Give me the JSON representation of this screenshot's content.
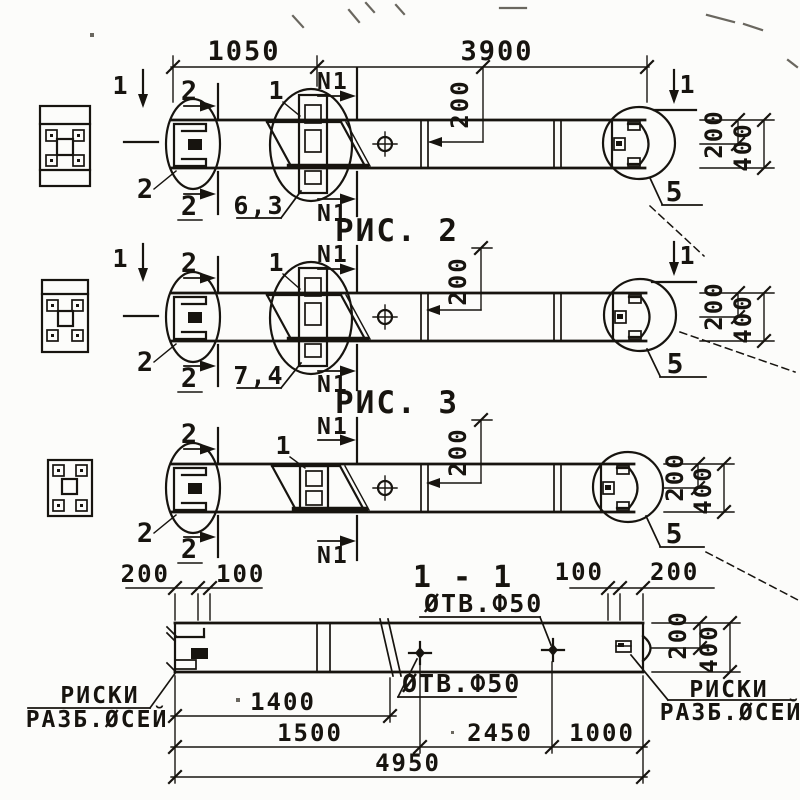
{
  "colors": {
    "ink": "#17140f",
    "paper": "#fcfcfa",
    "artifact": "#6a675f"
  },
  "labels": [
    {
      "n": "dim-1050",
      "t": "1050",
      "x": 244,
      "y": 60,
      "r": 0,
      "s": 27,
      "a": "middle"
    },
    {
      "n": "dim-3900",
      "t": "3900",
      "x": 497,
      "y": 60,
      "r": 0,
      "s": 27,
      "a": "middle"
    },
    {
      "n": "b1-dim-200-mid",
      "t": "200",
      "x": 468,
      "y": 104,
      "r": -90,
      "s": 24,
      "a": "middle"
    },
    {
      "n": "b1-section2-top",
      "t": "2",
      "x": 190,
      "y": 100,
      "r": 0,
      "s": 27,
      "a": "middle"
    },
    {
      "n": "b1-section2-bottom",
      "t": "2",
      "x": 190,
      "y": 215,
      "r": 0,
      "s": 27,
      "a": "middle"
    },
    {
      "n": "b1-leader-2",
      "t": "2",
      "x": 146,
      "y": 198,
      "r": 0,
      "s": 27,
      "a": "middle"
    },
    {
      "n": "b1-leader-1",
      "t": "1",
      "x": 277,
      "y": 99,
      "r": 0,
      "s": 25,
      "a": "middle"
    },
    {
      "n": "b1-n1-top",
      "t": "N1",
      "x": 317,
      "y": 89,
      "r": 0,
      "s": 23,
      "a": "start"
    },
    {
      "n": "b1-n1-bottom",
      "t": "N1",
      "x": 317,
      "y": 221,
      "r": 0,
      "s": 23,
      "a": "start"
    },
    {
      "n": "b1-weld-6-3",
      "t": "6,3",
      "x": 259,
      "y": 214,
      "r": 0,
      "s": 25,
      "a": "middle"
    },
    {
      "n": "b1-section1-left",
      "t": "1",
      "x": 121,
      "y": 94,
      "r": 0,
      "s": 25,
      "a": "middle"
    },
    {
      "n": "b1-section1-right",
      "t": "1",
      "x": 688,
      "y": 93,
      "r": 0,
      "s": 25,
      "a": "middle"
    },
    {
      "n": "b1-detail-5",
      "t": "5",
      "x": 675,
      "y": 201,
      "r": 0,
      "s": 28,
      "a": "middle"
    },
    {
      "n": "b1-dim-200-right",
      "t": "200",
      "x": 722,
      "y": 134,
      "r": -90,
      "s": 24,
      "a": "middle"
    },
    {
      "n": "b1-dim-400-right",
      "t": "400",
      "x": 751,
      "y": 147,
      "r": -90,
      "s": 24,
      "a": "middle"
    },
    {
      "n": "caption-fig-2",
      "t": "РИС. 2",
      "x": 397,
      "y": 241,
      "r": 0,
      "s": 31,
      "a": "middle"
    },
    {
      "n": "b2-dim-200-mid",
      "t": "200",
      "x": 466,
      "y": 281,
      "r": -90,
      "s": 24,
      "a": "middle"
    },
    {
      "n": "b2-section2-top",
      "t": "2",
      "x": 190,
      "y": 272,
      "r": 0,
      "s": 27,
      "a": "middle"
    },
    {
      "n": "b2-section2-bottom",
      "t": "2",
      "x": 190,
      "y": 387,
      "r": 0,
      "s": 27,
      "a": "middle"
    },
    {
      "n": "b2-leader-2",
      "t": "2",
      "x": 146,
      "y": 371,
      "r": 0,
      "s": 27,
      "a": "middle"
    },
    {
      "n": "b2-leader-1",
      "t": "1",
      "x": 277,
      "y": 271,
      "r": 0,
      "s": 25,
      "a": "middle"
    },
    {
      "n": "b2-n1-top",
      "t": "N1",
      "x": 317,
      "y": 262,
      "r": 0,
      "s": 23,
      "a": "start"
    },
    {
      "n": "b2-n1-bottom",
      "t": "N1",
      "x": 317,
      "y": 392,
      "r": 0,
      "s": 23,
      "a": "start"
    },
    {
      "n": "b2-weld-7-4",
      "t": "7,4",
      "x": 259,
      "y": 384,
      "r": 0,
      "s": 25,
      "a": "middle"
    },
    {
      "n": "b2-section1-left",
      "t": "1",
      "x": 121,
      "y": 267,
      "r": 0,
      "s": 25,
      "a": "middle"
    },
    {
      "n": "b2-section1-right",
      "t": "1",
      "x": 688,
      "y": 264,
      "r": 0,
      "s": 25,
      "a": "middle"
    },
    {
      "n": "b2-detail-5",
      "t": "5",
      "x": 676,
      "y": 373,
      "r": 0,
      "s": 28,
      "a": "middle"
    },
    {
      "n": "b2-dim-200-right",
      "t": "200",
      "x": 722,
      "y": 306,
      "r": -90,
      "s": 24,
      "a": "middle"
    },
    {
      "n": "b2-dim-400-right",
      "t": "400",
      "x": 751,
      "y": 319,
      "r": -90,
      "s": 24,
      "a": "middle"
    },
    {
      "n": "caption-fig-3",
      "t": "РИС. 3",
      "x": 397,
      "y": 413,
      "r": 0,
      "s": 31,
      "a": "middle"
    },
    {
      "n": "b3-dim-200-mid",
      "t": "200",
      "x": 466,
      "y": 452,
      "r": -90,
      "s": 24,
      "a": "middle"
    },
    {
      "n": "b3-section2-top",
      "t": "2",
      "x": 190,
      "y": 443,
      "r": 0,
      "s": 27,
      "a": "middle"
    },
    {
      "n": "b3-section2-bottom",
      "t": "2",
      "x": 190,
      "y": 558,
      "r": 0,
      "s": 27,
      "a": "middle"
    },
    {
      "n": "b3-leader-2",
      "t": "2",
      "x": 146,
      "y": 542,
      "r": 0,
      "s": 27,
      "a": "middle"
    },
    {
      "n": "b3-leader-1",
      "t": "1",
      "x": 284,
      "y": 454,
      "r": 0,
      "s": 25,
      "a": "middle"
    },
    {
      "n": "b3-n1-top",
      "t": "N1",
      "x": 317,
      "y": 434,
      "r": 0,
      "s": 23,
      "a": "start"
    },
    {
      "n": "b3-n1-bottom",
      "t": "N1",
      "x": 317,
      "y": 563,
      "r": 0,
      "s": 23,
      "a": "start"
    },
    {
      "n": "b3-detail-5",
      "t": "5",
      "x": 675,
      "y": 543,
      "r": 0,
      "s": 28,
      "a": "middle"
    },
    {
      "n": "b3-dim-200-right",
      "t": "200",
      "x": 683,
      "y": 477,
      "r": -90,
      "s": 24,
      "a": "middle"
    },
    {
      "n": "b3-dim-400-right",
      "t": "400",
      "x": 711,
      "y": 490,
      "r": -90,
      "s": 24,
      "a": "middle"
    },
    {
      "n": "caption-section-1-1",
      "t": "1 - 1",
      "x": 463,
      "y": 587,
      "r": 0,
      "s": 30,
      "a": "middle"
    },
    {
      "n": "note-otv-f50-top",
      "t": "ØТВ.Ф50",
      "x": 424,
      "y": 612,
      "r": 0,
      "s": 25,
      "a": "start"
    },
    {
      "n": "note-otv-f50-bottom",
      "t": "ØТВ.Ф50",
      "x": 402,
      "y": 692,
      "r": 0,
      "s": 25,
      "a": "start"
    },
    {
      "n": "s-dim-200-left",
      "t": "200",
      "x": 170,
      "y": 582,
      "r": 0,
      "s": 24,
      "a": "end"
    },
    {
      "n": "s-dim-100-left",
      "t": "100",
      "x": 216,
      "y": 582,
      "r": 0,
      "s": 24,
      "a": "start"
    },
    {
      "n": "s-dim-100-right",
      "t": "100",
      "x": 604,
      "y": 580,
      "r": 0,
      "s": 24,
      "a": "end"
    },
    {
      "n": "s-dim-200-right",
      "t": "200",
      "x": 650,
      "y": 580,
      "r": 0,
      "s": 24,
      "a": "start"
    },
    {
      "n": "s-dim-200-rdim",
      "t": "200",
      "x": 686,
      "y": 635,
      "r": -90,
      "s": 24,
      "a": "middle"
    },
    {
      "n": "s-dim-400-rdim",
      "t": "400",
      "x": 717,
      "y": 649,
      "r": -90,
      "s": 24,
      "a": "middle"
    },
    {
      "n": "riski-left-line1",
      "t": "РИСКИ",
      "x": 100,
      "y": 703,
      "r": 0,
      "s": 23,
      "a": "middle"
    },
    {
      "n": "riski-left-line2",
      "t": "РАЗБ.ØСЕЙ",
      "x": 97,
      "y": 727,
      "r": 0,
      "s": 23,
      "a": "middle"
    },
    {
      "n": "riski-right-line1",
      "t": "РИСКИ",
      "x": 729,
      "y": 697,
      "r": 0,
      "s": 23,
      "a": "middle"
    },
    {
      "n": "riski-right-line2",
      "t": "РАЗБ.ØСЕЙ",
      "x": 731,
      "y": 720,
      "r": 0,
      "s": 23,
      "a": "middle"
    },
    {
      "n": "dim-1400",
      "t": "1400",
      "x": 283,
      "y": 710,
      "r": 0,
      "s": 24,
      "a": "middle"
    },
    {
      "n": "dim-1500",
      "t": "1500",
      "x": 310,
      "y": 741,
      "r": 0,
      "s": 24,
      "a": "middle"
    },
    {
      "n": "dim-2450",
      "t": "2450",
      "x": 500,
      "y": 741,
      "r": 0,
      "s": 24,
      "a": "middle"
    },
    {
      "n": "dim-1000",
      "t": "1000",
      "x": 602,
      "y": 741,
      "r": 0,
      "s": 24,
      "a": "middle"
    },
    {
      "n": "dim-4950",
      "t": "4950",
      "x": 408,
      "y": 771,
      "r": 0,
      "s": 24,
      "a": "middle"
    }
  ]
}
